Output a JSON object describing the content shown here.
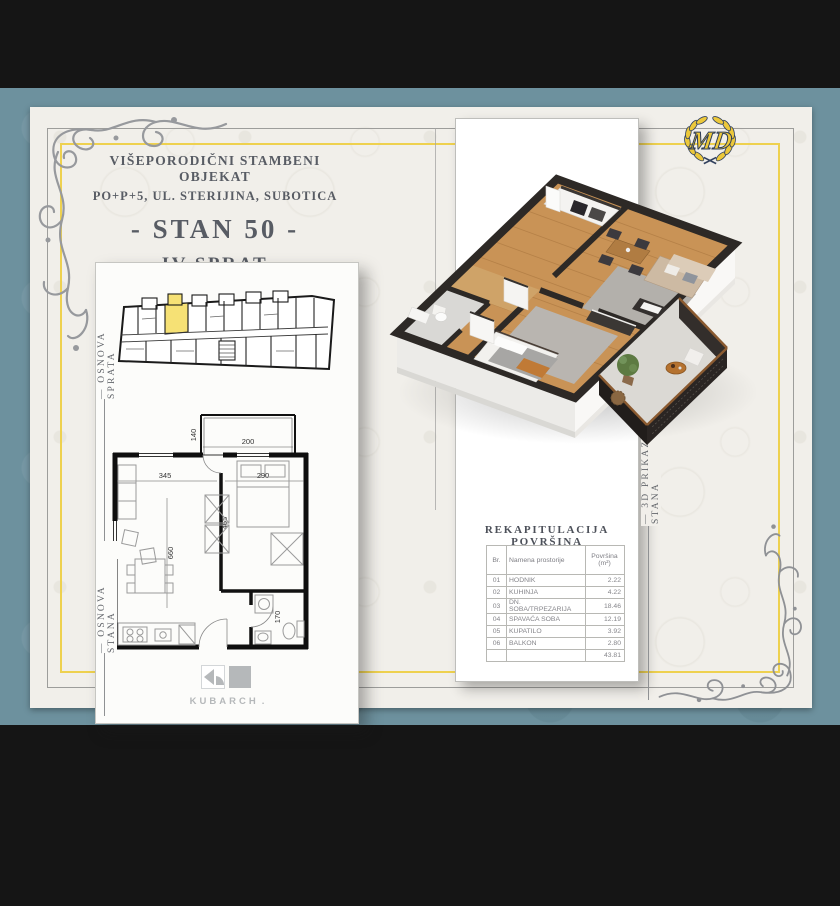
{
  "header": {
    "line1": "VIŠEPORODIČNI STAMBENI OBJEKAT",
    "line2": "PO+P+5, UL. STERIJINA, SUBOTICA",
    "line3": "- STAN 50 -",
    "line4": "IV SPRAT",
    "line5": "JEDNOIPOSOBAN"
  },
  "logo": {
    "monogram": "MD"
  },
  "side_labels": {
    "floor_overview": "— OSNOVA SPRATA",
    "unit_plan": "— OSNOVA STANA",
    "render_3d": "— 3D PRIKAZ STANA"
  },
  "plan_dims": {
    "balcony_depth": "140",
    "balcony_width": "200",
    "living_width": "345",
    "bedroom_width": "290",
    "bedroom_depth": "465",
    "living_depth": "660",
    "bath_depth": "170"
  },
  "recap": {
    "title": "REKAPITULACIJA POVRŠINA",
    "col_br": "Br.",
    "col_name": "Namena prostorije",
    "col_area_line1": "Površina",
    "col_area_line2": "(m²)",
    "rows": [
      {
        "br": "01",
        "name": "HODNIK",
        "area": "2.22"
      },
      {
        "br": "02",
        "name": "KUHINJA",
        "area": "4.22"
      },
      {
        "br": "03",
        "name": "DN. SOBA/TRPEZARIJA",
        "area": "18.46"
      },
      {
        "br": "04",
        "name": "SPAVAĆA SOBA",
        "area": "12.19"
      },
      {
        "br": "05",
        "name": "KUPATILO",
        "area": "3.92"
      },
      {
        "br": "06",
        "name": "BALKON",
        "area": "2.80"
      }
    ],
    "total": "43.81"
  },
  "studio": {
    "name": "KUBARCH",
    "dot": "."
  },
  "colors": {
    "teal_band": "#6d919e",
    "card": "#f1efea",
    "gold_frame": "#eed14f",
    "highlight_unit": "#f6e175",
    "logo_gold": "#ecc83a",
    "logo_navy": "#33425f",
    "wood_floor": "#c99356"
  }
}
